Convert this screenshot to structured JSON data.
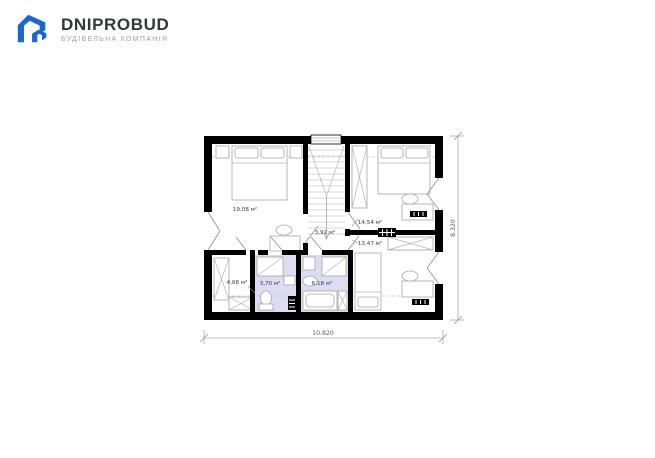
{
  "brand": {
    "name": "DNIPROBUD",
    "tagline": "БУДІВЕЛЬНА КОМПАНІЯ",
    "logo_color": "#1b66d0",
    "name_color": "#32373c",
    "tagline_color": "#9ba1a7"
  },
  "plan": {
    "type": "attic-floor-plan",
    "rooms": [
      {
        "id": "bedroom-1",
        "area": "19,08 м²"
      },
      {
        "id": "hall",
        "area": "3,92 м²"
      },
      {
        "id": "bedroom-2",
        "area": "14,54 м²"
      },
      {
        "id": "bedroom-3",
        "area": "13,47 м²"
      },
      {
        "id": "wardrobe",
        "area": "4,68 м²"
      },
      {
        "id": "bathroom-1",
        "area": "3,70 м²"
      },
      {
        "id": "bathroom-2",
        "area": "6,18 м²"
      }
    ],
    "dimensions": {
      "width_label": "10.820",
      "height_label": "8.320"
    },
    "colors": {
      "wall": "#000000",
      "bathroom_floor": "#dcdcf2",
      "furniture_line": "#a6a6a6",
      "dimension_line": "#8a8a8a"
    }
  }
}
